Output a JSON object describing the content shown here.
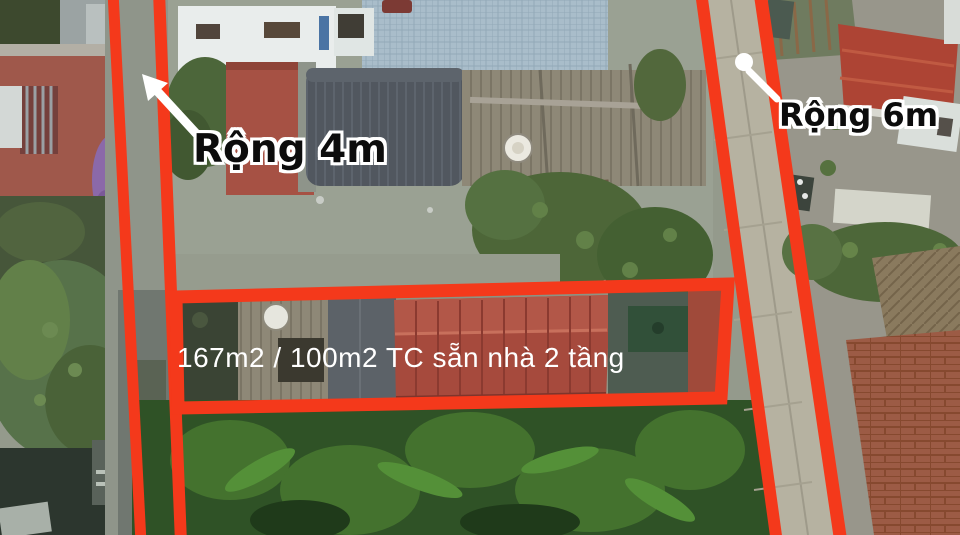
{
  "annotations": {
    "left_road_width_label": "Rộng 4m",
    "right_road_width_label": "Rộng 6m",
    "area_label": "167m2 / 100m2 TC sẵn nhà 2 tầng"
  },
  "colors": {
    "boundary": "#f4391b",
    "label_text": "#0c0c0c",
    "label_outline": "#ffffff",
    "area_text": "#ffffff",
    "arrow": "#ffffff"
  },
  "icons": {
    "width_arrow": "diagonal-arrow-up-left",
    "road_pin": "circle-pin-marker"
  }
}
